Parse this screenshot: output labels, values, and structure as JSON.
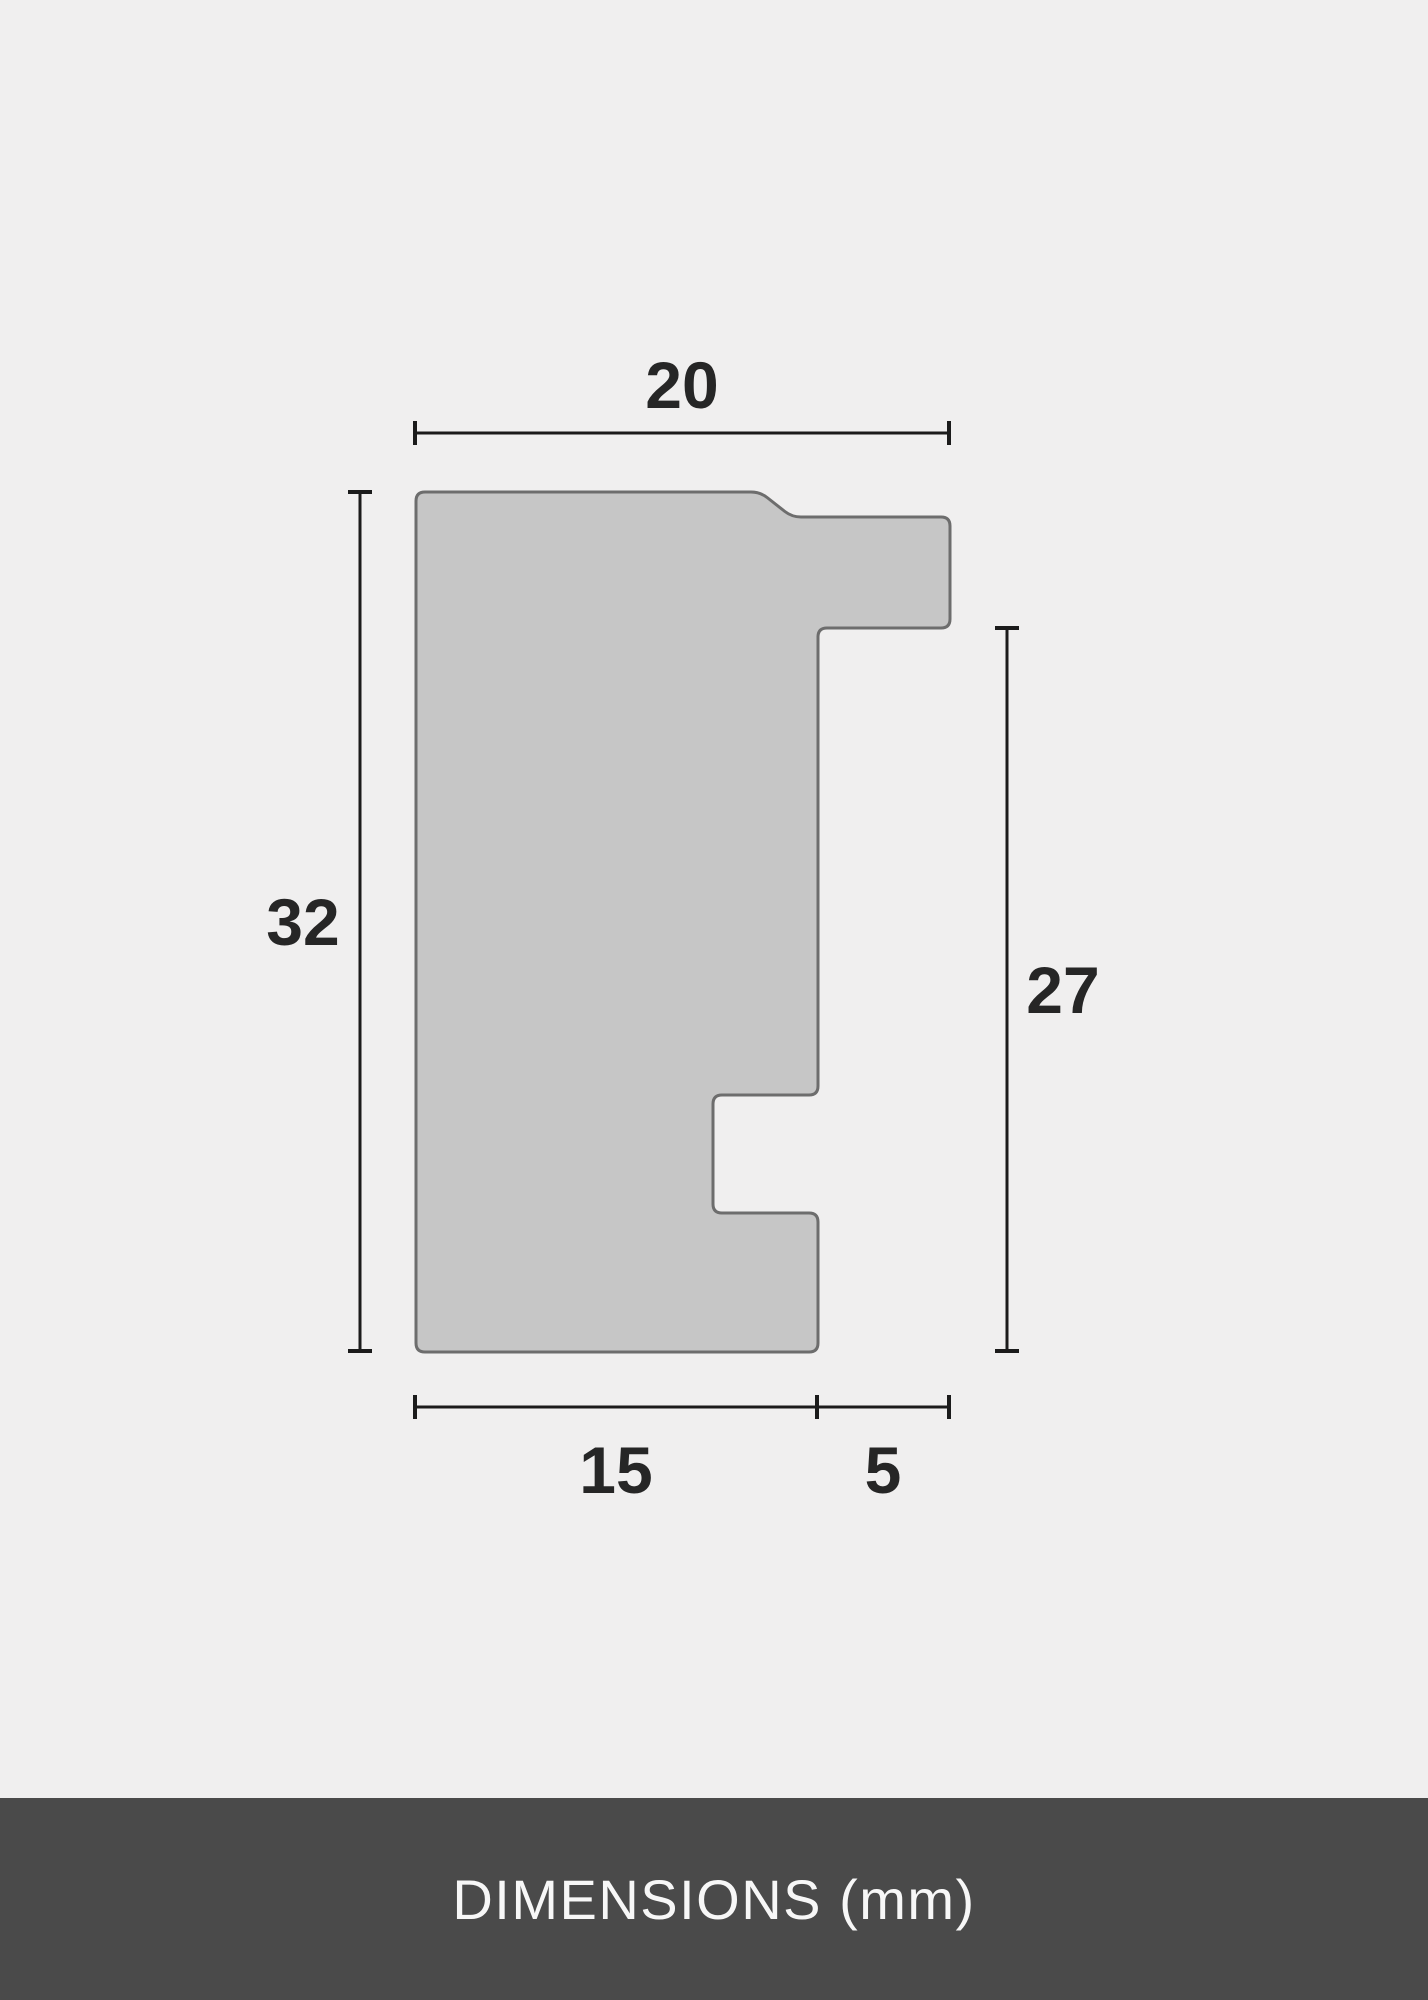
{
  "colors": {
    "background": "#f0efef",
    "shape_fill": "#c6c6c6",
    "shape_stroke": "#6d6d6d",
    "dimension_line": "#1b1b1b",
    "label_text": "#262626",
    "footer_background": "#4a4a4a",
    "footer_text": "#f7f7f7"
  },
  "diagram": {
    "unit": "mm",
    "dimensions": {
      "top": "20",
      "left": "32",
      "right": "27",
      "bottom_left": "15",
      "bottom_right": "5"
    },
    "profile_points": [
      [
        416,
        492
      ],
      [
        760,
        492
      ],
      [
        792,
        517
      ],
      [
        950,
        517
      ],
      [
        950,
        628
      ],
      [
        818,
        628
      ],
      [
        818,
        1095
      ],
      [
        713,
        1095
      ],
      [
        713,
        1213
      ],
      [
        818,
        1213
      ],
      [
        818,
        1352
      ],
      [
        416,
        1352
      ]
    ],
    "corner_radius": 9
  },
  "footer": {
    "title": "DIMENSIONS (mm)"
  }
}
